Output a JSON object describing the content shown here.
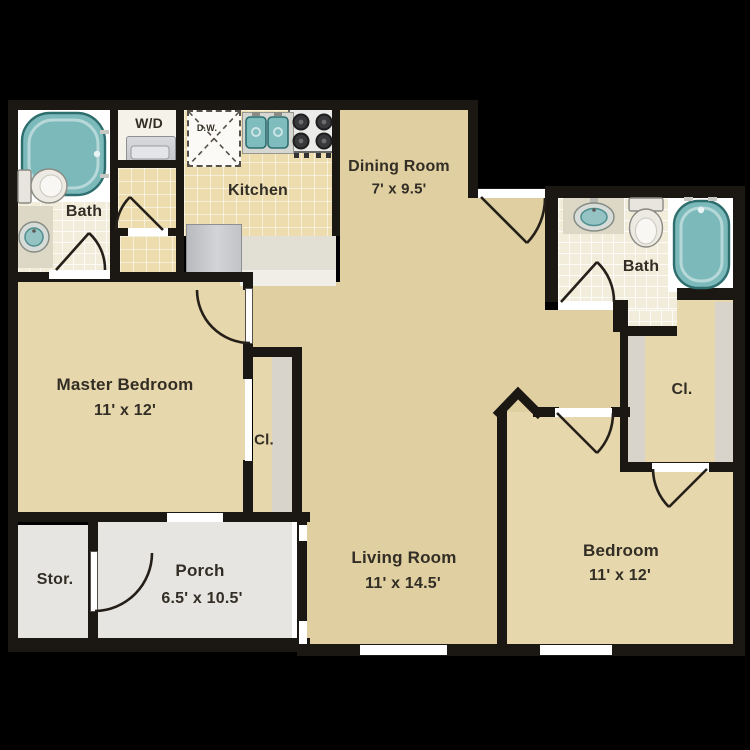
{
  "plan": {
    "title": "apartment-floor-plan",
    "rooms": {
      "master": {
        "label": "Master Bedroom",
        "dims": "11' x 12'"
      },
      "living": {
        "label": "Living Room",
        "dims": "11' x 14.5'"
      },
      "dining": {
        "label": "Dining Room",
        "dims": "7' x 9.5'"
      },
      "kitchen": {
        "label": "Kitchen"
      },
      "bedroom": {
        "label": "Bedroom",
        "dims": "11' x 12'"
      },
      "bath_left": {
        "label": "Bath"
      },
      "bath_right": {
        "label": "Bath"
      },
      "porch": {
        "label": "Porch",
        "dims": "6.5' x 10.5'"
      },
      "storage": {
        "label": "Stor."
      },
      "closet_left": {
        "label": "Cl."
      },
      "closet_right": {
        "label": "Cl."
      },
      "laundry": {
        "label": "W/D"
      },
      "dishwasher": {
        "label": "D.W."
      }
    },
    "fixtures": [
      "bathtub-left",
      "toilet-left",
      "sink-left",
      "washer-dryer",
      "dishwasher",
      "kitchen-double-sink",
      "stove",
      "refrigerator",
      "kitchen-counter",
      "sink-right",
      "toilet-right",
      "bathtub-right",
      "closet-shelves"
    ],
    "colors": {
      "background": "#000000",
      "walls": "#1b1712",
      "room_beige": "#dfcfa1",
      "room_beige_light": "#e6d7ad",
      "kitchen_tile": "#ecdcae",
      "bath_tile": "#f2ecdb",
      "porch_gray": "#e6e5e1",
      "fixture_teal": "#7cb9ba",
      "thresholds": "#ffffff"
    }
  }
}
